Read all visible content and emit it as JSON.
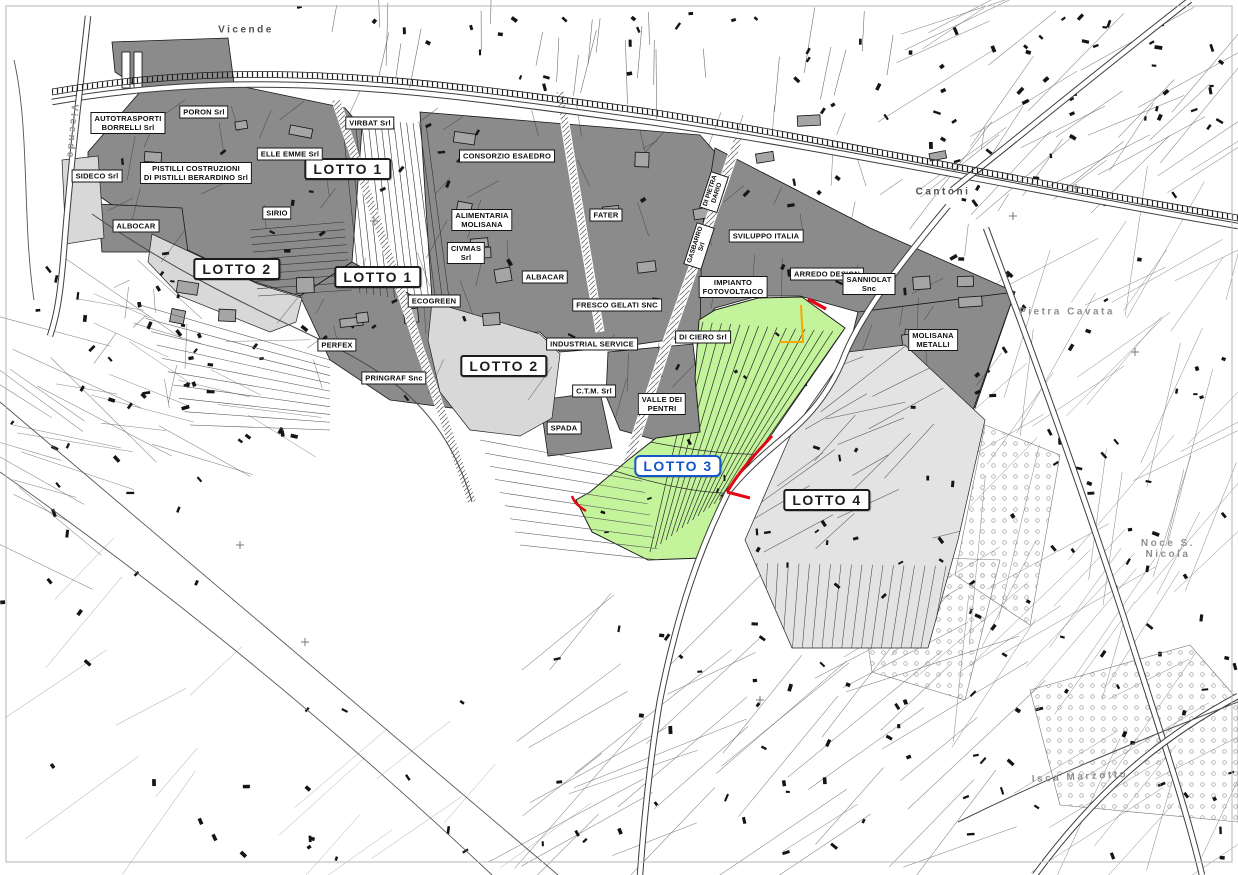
{
  "map": {
    "type": "cadastral-industrial-zone-map",
    "colors": {
      "parcel_dark": "#8b8b8b",
      "parcel_light": "#d8d8d8",
      "lotto4_fill": "#e3e3e3",
      "lotto3_green": "#c3f39a",
      "lotto3_blue": "#1456c9",
      "boundary_red": "#e30613",
      "boundary_orange": "#f7a600",
      "map_line": "#1a1a1a"
    },
    "lot_labels": [
      {
        "id": "lotto-1-a",
        "text": "LOTTO 1",
        "x": 348,
        "y": 169,
        "style": "black"
      },
      {
        "id": "lotto-1-b",
        "text": "LOTTO 1",
        "x": 378,
        "y": 277,
        "style": "black"
      },
      {
        "id": "lotto-2-a",
        "text": "LOTTO 2",
        "x": 237,
        "y": 269,
        "style": "black"
      },
      {
        "id": "lotto-2-b",
        "text": "LOTTO 2",
        "x": 504,
        "y": 366,
        "style": "black"
      },
      {
        "id": "lotto-3",
        "text": "LOTTO 3",
        "x": 678,
        "y": 466,
        "style": "blue"
      },
      {
        "id": "lotto-4",
        "text": "LOTTO 4",
        "x": 827,
        "y": 500,
        "style": "black"
      }
    ],
    "company_labels": [
      {
        "text": "AUTOTRASPORTI\nBORRELLI  Srl",
        "x": 128,
        "y": 123
      },
      {
        "text": "PORON Srl",
        "x": 204,
        "y": 112
      },
      {
        "text": "SIDECO Srl",
        "x": 97,
        "y": 176
      },
      {
        "text": "PISTILLI COSTRUZIONI\nDI PISTILLI BERARDINO Srl",
        "x": 196,
        "y": 173
      },
      {
        "text": "ELLE EMME Srl",
        "x": 290,
        "y": 154
      },
      {
        "text": "SIRIO",
        "x": 277,
        "y": 213
      },
      {
        "text": "ALBOCAR",
        "x": 136,
        "y": 226
      },
      {
        "text": "VIRBAT Srl",
        "x": 370,
        "y": 123
      },
      {
        "text": "CONSORZIO ESAEDRO",
        "x": 507,
        "y": 156
      },
      {
        "text": "ALIMENTARIA\nMOLISANA",
        "x": 482,
        "y": 220
      },
      {
        "text": "CIVMAS\nSrl",
        "x": 466,
        "y": 253
      },
      {
        "text": "ALBACAR",
        "x": 545,
        "y": 277
      },
      {
        "text": "ECOGREEN",
        "x": 434,
        "y": 301
      },
      {
        "text": "FATER",
        "x": 606,
        "y": 215
      },
      {
        "text": "SVILUPPO ITALIA",
        "x": 766,
        "y": 236
      },
      {
        "text": "ARREDO DESIGN",
        "x": 827,
        "y": 274
      },
      {
        "text": "SANNIOLAT\nSnc",
        "x": 869,
        "y": 284
      },
      {
        "text": "IMPIANTO\nFOTOVOLTAICO",
        "x": 733,
        "y": 287
      },
      {
        "text": "FRESCO GELATI SNC",
        "x": 617,
        "y": 305
      },
      {
        "text": "DI CIERO Srl",
        "x": 703,
        "y": 337
      },
      {
        "text": "INDUSTRIAL SERVICE",
        "x": 592,
        "y": 344
      },
      {
        "text": "MOLISANA\nMETALLI",
        "x": 933,
        "y": 340
      },
      {
        "text": "PERFEX",
        "x": 337,
        "y": 345
      },
      {
        "text": "PRINGRAF Snc",
        "x": 394,
        "y": 378
      },
      {
        "text": "C.T.M. Srl",
        "x": 594,
        "y": 391
      },
      {
        "text": "VALLE DEI\nPENTRI",
        "x": 662,
        "y": 404
      },
      {
        "text": "SPADA",
        "x": 564,
        "y": 428
      }
    ],
    "place_labels": [
      {
        "id": "vicende-top",
        "text": "Vicende",
        "x": 246,
        "y": 30,
        "angle": 0,
        "muted": false
      },
      {
        "id": "vicende-left",
        "text": "Vicende",
        "x": 72,
        "y": 132,
        "angle": 95,
        "muted": true
      },
      {
        "id": "cantoni",
        "text": "Cantoni",
        "x": 943,
        "y": 192,
        "angle": 0,
        "muted": false
      },
      {
        "id": "pietra-cavata",
        "text": "Pietra Cavata",
        "x": 1067,
        "y": 312,
        "angle": 0,
        "muted": true
      },
      {
        "id": "noce-s-nicola",
        "text": "Noce  S. Nicola",
        "x": 1168,
        "y": 549,
        "angle": 0,
        "muted": true
      },
      {
        "id": "isca-marzotto",
        "text": "Isca  Marzotto",
        "x": 1080,
        "y": 777,
        "angle": -3,
        "muted": true
      }
    ],
    "rotated_road_labels": [
      {
        "id": "di-pietra-dario",
        "text": "DI PIETRA\nDARIO",
        "x": 714,
        "y": 192,
        "angle": -72
      },
      {
        "id": "gasbarro-srl",
        "text": "GASBARRO\nSrl",
        "x": 699,
        "y": 246,
        "angle": -72
      }
    ]
  }
}
